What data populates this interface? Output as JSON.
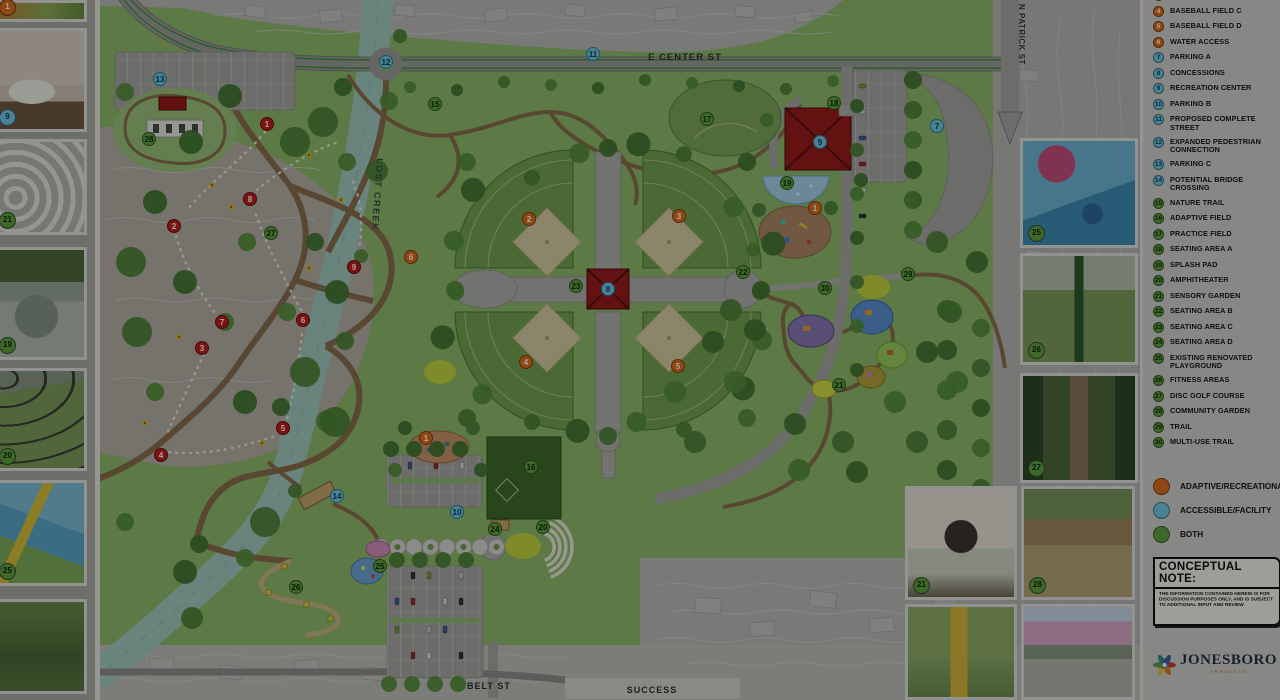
{
  "map": {
    "street_labels": {
      "e_center": "E CENTER ST",
      "n_patrick": "N PATRICK ST",
      "belt": "BELT ST",
      "success": "SUCCESS"
    },
    "creek_label": "LOST CREEK",
    "markers": [
      {
        "n": "11",
        "t": "b",
        "x": 498,
        "y": 54
      },
      {
        "n": "12",
        "t": "b",
        "x": 291,
        "y": 62
      },
      {
        "n": "13",
        "t": "b",
        "x": 65,
        "y": 79
      },
      {
        "n": "7",
        "t": "b",
        "x": 842,
        "y": 126
      },
      {
        "n": "9",
        "t": "b",
        "x": 725,
        "y": 142
      },
      {
        "n": "8",
        "t": "b",
        "x": 513,
        "y": 289
      },
      {
        "n": "10",
        "t": "b",
        "x": 362,
        "y": 512
      },
      {
        "n": "14",
        "t": "b",
        "x": 242,
        "y": 496
      },
      {
        "n": "1",
        "t": "o",
        "x": 720,
        "y": 208
      },
      {
        "n": "1",
        "t": "o",
        "x": 331,
        "y": 438
      },
      {
        "n": "2",
        "t": "o",
        "x": 434,
        "y": 219
      },
      {
        "n": "3",
        "t": "o",
        "x": 584,
        "y": 216
      },
      {
        "n": "4",
        "t": "o",
        "x": 431,
        "y": 362
      },
      {
        "n": "5",
        "t": "o",
        "x": 583,
        "y": 366
      },
      {
        "n": "6",
        "t": "o",
        "x": 316,
        "y": 257
      },
      {
        "n": "15",
        "t": "g",
        "x": 340,
        "y": 104
      },
      {
        "n": "16",
        "t": "g",
        "x": 436,
        "y": 467
      },
      {
        "n": "17",
        "t": "g",
        "x": 612,
        "y": 119
      },
      {
        "n": "18",
        "t": "g",
        "x": 739,
        "y": 103
      },
      {
        "n": "19",
        "t": "g",
        "x": 692,
        "y": 183
      },
      {
        "n": "20",
        "t": "g",
        "x": 448,
        "y": 527
      },
      {
        "n": "21",
        "t": "g",
        "x": 744,
        "y": 385
      },
      {
        "n": "22",
        "t": "g",
        "x": 648,
        "y": 272
      },
      {
        "n": "23",
        "t": "g",
        "x": 481,
        "y": 286
      },
      {
        "n": "24",
        "t": "g",
        "x": 400,
        "y": 529
      },
      {
        "n": "25",
        "t": "g",
        "x": 285,
        "y": 566
      },
      {
        "n": "26",
        "t": "g",
        "x": 201,
        "y": 587
      },
      {
        "n": "27",
        "t": "g",
        "x": 176,
        "y": 233
      },
      {
        "n": "28",
        "t": "g",
        "x": 54,
        "y": 139
      },
      {
        "n": "29",
        "t": "g",
        "x": 813,
        "y": 274
      },
      {
        "n": "30",
        "t": "g",
        "x": 730,
        "y": 288
      },
      {
        "n": "1",
        "t": "r",
        "x": 172,
        "y": 124
      },
      {
        "n": "2",
        "t": "r",
        "x": 79,
        "y": 226
      },
      {
        "n": "3",
        "t": "r",
        "x": 107,
        "y": 348
      },
      {
        "n": "4",
        "t": "r",
        "x": 66,
        "y": 455
      },
      {
        "n": "5",
        "t": "r",
        "x": 188,
        "y": 428
      },
      {
        "n": "6",
        "t": "r",
        "x": 208,
        "y": 320
      },
      {
        "n": "7",
        "t": "r",
        "x": 127,
        "y": 322
      },
      {
        "n": "8",
        "t": "r",
        "x": 155,
        "y": 199
      },
      {
        "n": "9",
        "t": "r",
        "x": 259,
        "y": 267
      }
    ]
  },
  "legend": {
    "partial_top_item": {
      "num": "3",
      "label": "BASEBALL FIELD B",
      "type": "o"
    },
    "items": [
      {
        "num": "4",
        "label": "BASEBALL FIELD C",
        "type": "o"
      },
      {
        "num": "5",
        "label": "BASEBALL FIELD D",
        "type": "o"
      },
      {
        "num": "6",
        "label": "WATER ACCESS",
        "type": "o"
      },
      {
        "num": "7",
        "label": "PARKING A",
        "type": "b"
      },
      {
        "num": "8",
        "label": "CONCESSIONS",
        "type": "b"
      },
      {
        "num": "9",
        "label": "RECREATION CENTER",
        "type": "b"
      },
      {
        "num": "10",
        "label": "PARKING B",
        "type": "b"
      },
      {
        "num": "11",
        "label": "PROPOSED COMPLETE STREET",
        "type": "b"
      },
      {
        "num": "12",
        "label": "EXPANDED PEDESTRIAN CONNECTION",
        "type": "b"
      },
      {
        "num": "13",
        "label": "PARKING C",
        "type": "b"
      },
      {
        "num": "14",
        "label": "POTENTIAL BRIDGE CROSSING",
        "type": "b"
      },
      {
        "num": "15",
        "label": "NATURE TRAIL",
        "type": "g"
      },
      {
        "num": "16",
        "label": "ADAPTIVE  FIELD",
        "type": "g"
      },
      {
        "num": "17",
        "label": "PRACTICE FIELD",
        "type": "g"
      },
      {
        "num": "18",
        "label": "SEATING AREA A",
        "type": "g"
      },
      {
        "num": "19",
        "label": "SPLASH PAD",
        "type": "g"
      },
      {
        "num": "20",
        "label": "AMPHITHEATER",
        "type": "g"
      },
      {
        "num": "21",
        "label": "SENSORY GARDEN",
        "type": "g"
      },
      {
        "num": "22",
        "label": "SEATING AREA B",
        "type": "g"
      },
      {
        "num": "23",
        "label": "SEATING AREA C",
        "type": "g"
      },
      {
        "num": "24",
        "label": "SEATING AREA D",
        "type": "g"
      },
      {
        "num": "25",
        "label": "EXISTING RENOVATED PLAYGROUND",
        "type": "g"
      },
      {
        "num": "26",
        "label": "FITNESS AREAS",
        "type": "g"
      },
      {
        "num": "27",
        "label": "DISC GOLF COURSE",
        "type": "g"
      },
      {
        "num": "28",
        "label": "COMMUNITY GARDEN",
        "type": "g"
      },
      {
        "num": "29",
        "label": "TRAIL",
        "type": "g"
      },
      {
        "num": "30",
        "label": "MULTI-USE TRAIL",
        "type": "g"
      }
    ],
    "key": [
      {
        "label": "ADAPTIVE/RECREATIONAL",
        "type": "o"
      },
      {
        "label": "ACCESSIBLE/FACILITY",
        "type": "b"
      },
      {
        "label": "BOTH",
        "type": "g"
      }
    ],
    "colors": {
      "o": "#e0701f",
      "b": "#72c9e8",
      "g": "#61a342",
      "r": "#c01f1f"
    },
    "note": {
      "title": "CONCEPTUAL NOTE:",
      "body": "THE INFORMATION CONTAINED HEREIN IS FOR DISCUSSION PURPOSES ONLY, AND IS SUBJECT TO ADDITIONAL INPUT AND REVIEW"
    },
    "logo": {
      "name": "JONESBORO",
      "sub": "ARKANSAS"
    }
  },
  "photos": {
    "left": [
      {
        "badge": "1",
        "type": "o"
      },
      {
        "badge": "9",
        "type": "b"
      },
      {
        "badge": "21",
        "type": "g"
      },
      {
        "badge": "19",
        "type": "g"
      },
      {
        "badge": "20",
        "type": "g"
      },
      {
        "badge": "25",
        "type": "g"
      },
      {
        "badge": "",
        "type": ""
      }
    ],
    "right": [
      {
        "badge": "25",
        "type": "g"
      },
      {
        "badge": "26",
        "type": "g"
      },
      {
        "badge": "27",
        "type": "g"
      }
    ],
    "bottom": [
      {
        "badge": "21",
        "type": "g"
      },
      {
        "badge": "28",
        "type": "g"
      },
      {
        "badge": "",
        "type": ""
      },
      {
        "badge": "",
        "type": ""
      }
    ]
  }
}
